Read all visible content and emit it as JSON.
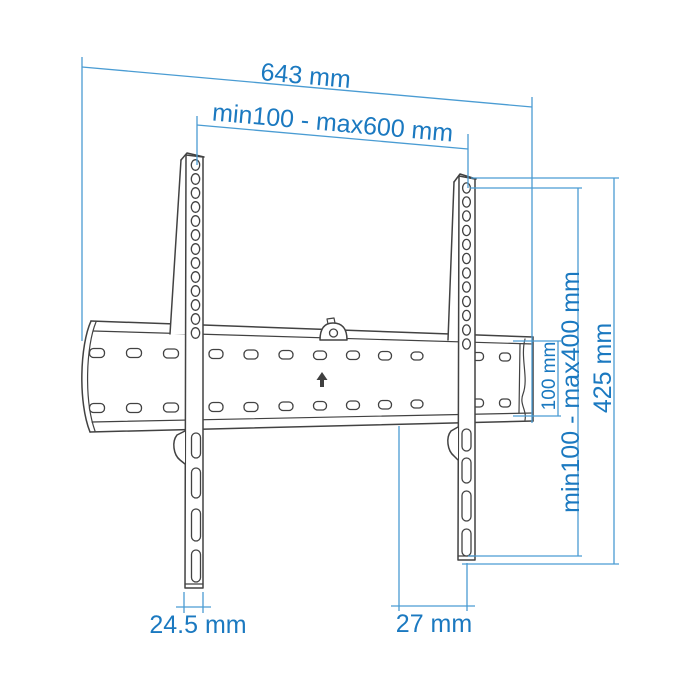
{
  "diagram": {
    "type": "technical-drawing",
    "subject": "TV wall mount bracket - front view with dimensions",
    "unit": "mm",
    "labels": {
      "total_width": "643 mm",
      "vesa_width_range": "min100 - max600 mm",
      "total_height": "425 mm",
      "vesa_height_range": "min100 - max400 mm",
      "plate_height": "100 mm",
      "rail_width": "24.5 mm",
      "mount_depth": "27 mm"
    },
    "colors": {
      "dimension_text": "#1b79c0",
      "dimension_line": "#4a9cd3",
      "drawing_line": "#424242",
      "background": "#ffffff"
    },
    "icons": {
      "lock": "lock-icon",
      "arrow_up": "arrow-up-icon"
    }
  }
}
